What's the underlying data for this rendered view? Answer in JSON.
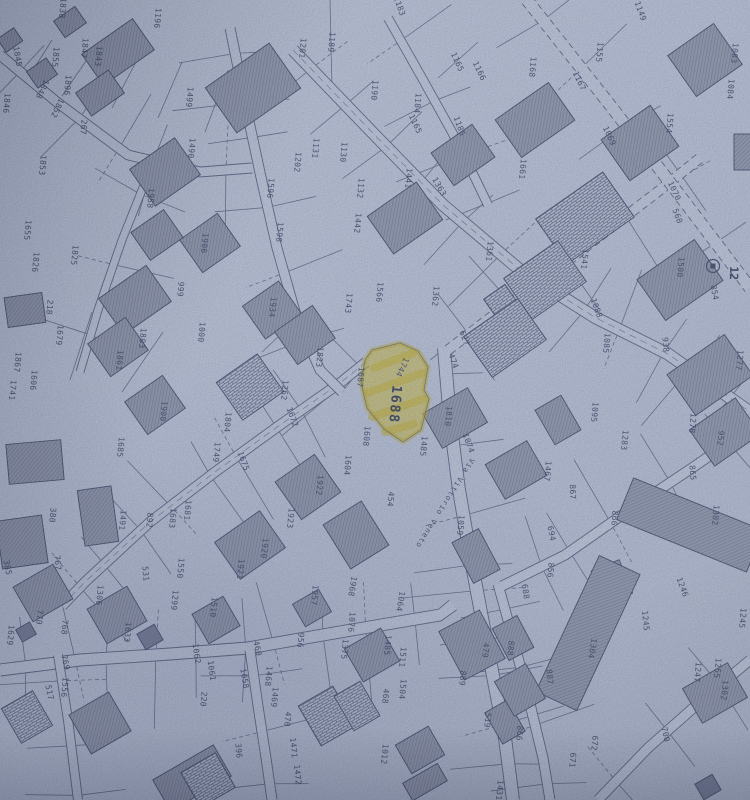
{
  "map": {
    "paper_color": "#c5cee1",
    "line_color": "#3e4968",
    "building_color": "#99a1b4",
    "highlight": {
      "parcel_number": "1688",
      "color": "#ddc62e"
    },
    "street": {
      "name": "Via Vittorio Veneto"
    },
    "marker": {
      "label": "12"
    },
    "labels": [
      [
        "1838",
        60,
        8,
        95
      ],
      [
        "1196",
        155,
        18,
        95
      ],
      [
        "1183",
        397,
        7,
        70
      ],
      [
        "1189",
        329,
        42,
        95
      ],
      [
        "1201",
        300,
        48,
        95
      ],
      [
        "1190",
        372,
        90,
        95
      ],
      [
        "1184",
        415,
        103,
        95
      ],
      [
        "1165",
        455,
        63,
        65
      ],
      [
        "1165",
        413,
        125,
        65
      ],
      [
        "1166",
        477,
        72,
        65
      ],
      [
        "1186",
        457,
        127,
        70
      ],
      [
        "1149",
        638,
        12,
        70
      ],
      [
        "1155",
        597,
        52,
        95
      ],
      [
        "1168",
        530,
        67,
        95
      ],
      [
        "1167",
        577,
        82,
        65
      ],
      [
        "1083",
        732,
        53,
        95
      ],
      [
        "1084",
        728,
        89,
        95
      ],
      [
        "1554",
        667,
        123,
        95
      ],
      [
        "1069",
        607,
        137,
        65
      ],
      [
        "1070",
        672,
        192,
        65
      ],
      [
        "1661",
        520,
        169,
        95
      ],
      [
        "1363",
        437,
        188,
        60
      ],
      [
        "1441",
        406,
        178,
        95
      ],
      [
        "1442",
        355,
        223,
        95
      ],
      [
        "1132",
        358,
        188,
        95
      ],
      [
        "1131",
        313,
        148,
        95
      ],
      [
        "1130",
        341,
        152,
        95
      ],
      [
        "1202",
        295,
        162,
        95
      ],
      [
        "1596",
        268,
        188,
        95
      ],
      [
        "1598",
        277,
        232,
        95
      ],
      [
        "1845",
        15,
        57,
        80
      ],
      [
        "1855",
        53,
        57,
        95
      ],
      [
        "1847",
        82,
        48,
        95
      ],
      [
        "1843",
        96,
        56,
        95
      ],
      [
        "1896",
        65,
        85,
        95
      ],
      [
        "1848",
        40,
        88,
        115
      ],
      [
        "1846",
        4,
        103,
        95
      ],
      [
        "1852",
        55,
        107,
        115
      ],
      [
        "267",
        81,
        127,
        95
      ],
      [
        "1853",
        40,
        165,
        95
      ],
      [
        "1499",
        187,
        97,
        95
      ],
      [
        "1490",
        189,
        148,
        95
      ],
      [
        "1958",
        148,
        198,
        95
      ],
      [
        "1906",
        202,
        243,
        95
      ],
      [
        "1655",
        25,
        230,
        95
      ],
      [
        "1826",
        33,
        262,
        95
      ],
      [
        "1825",
        72,
        255,
        95
      ],
      [
        "218",
        47,
        307,
        95
      ],
      [
        "1679",
        57,
        335,
        95
      ],
      [
        "999",
        178,
        289,
        95
      ],
      [
        "1000",
        199,
        332,
        95
      ],
      [
        "1803",
        140,
        338,
        95
      ],
      [
        "1934",
        270,
        307,
        95
      ],
      [
        "1823",
        317,
        357,
        95
      ],
      [
        "1566",
        377,
        292,
        95
      ],
      [
        "1743",
        346,
        303,
        95
      ],
      [
        "1362",
        433,
        296,
        95
      ],
      [
        "1361",
        487,
        251,
        95
      ],
      [
        "1541",
        582,
        259,
        95
      ],
      [
        "1500",
        678,
        267,
        95
      ],
      [
        "854",
        712,
        293,
        80
      ],
      [
        "560",
        675,
        217,
        70
      ],
      [
        "1088",
        594,
        309,
        70
      ],
      [
        "938",
        663,
        345,
        85
      ],
      [
        "1085",
        604,
        343,
        95
      ],
      [
        "1277",
        737,
        360,
        95
      ],
      [
        "1867",
        15,
        362,
        95
      ],
      [
        "1861",
        117,
        360,
        95
      ],
      [
        "1741",
        10,
        390,
        95
      ],
      [
        "1606",
        31,
        380,
        95
      ],
      [
        "1900",
        161,
        411,
        95
      ],
      [
        "1685",
        118,
        447,
        95
      ],
      [
        "1262",
        282,
        390,
        95
      ],
      [
        "1687",
        358,
        377,
        95
      ],
      [
        "1744",
        400,
        366,
        115
      ],
      [
        "1672",
        290,
        418,
        70
      ],
      [
        "1675",
        241,
        462,
        70
      ],
      [
        "1804",
        225,
        422,
        95
      ],
      [
        "1749",
        214,
        452,
        95
      ],
      [
        "1604",
        345,
        465,
        95
      ],
      [
        "1608",
        364,
        436,
        95
      ],
      [
        "1810",
        446,
        416,
        95
      ],
      [
        "1485",
        421,
        446,
        95
      ],
      [
        "1074",
        466,
        444,
        70
      ],
      [
        "627",
        462,
        339,
        70
      ],
      [
        "474",
        451,
        362,
        70
      ],
      [
        "1095",
        592,
        412,
        95
      ],
      [
        "1278",
        690,
        423,
        95
      ],
      [
        "952",
        718,
        438,
        95
      ],
      [
        "1283",
        622,
        440,
        95
      ],
      [
        "454",
        388,
        499,
        95
      ],
      [
        "1467",
        545,
        471,
        95
      ],
      [
        "867",
        570,
        492,
        88
      ],
      [
        "865",
        690,
        473,
        85
      ],
      [
        "866",
        612,
        518,
        95
      ],
      [
        "1302",
        713,
        515,
        95
      ],
      [
        "1922",
        317,
        485,
        95
      ],
      [
        "1923",
        288,
        518,
        95
      ],
      [
        "380",
        50,
        515,
        95
      ],
      [
        "1491",
        120,
        520,
        95
      ],
      [
        "892",
        147,
        520,
        95
      ],
      [
        "1681",
        185,
        510,
        95
      ],
      [
        "1683",
        170,
        518,
        95
      ],
      [
        "1059",
        458,
        525,
        95
      ],
      [
        "694",
        549,
        534,
        78
      ],
      [
        "1245",
        740,
        618,
        95
      ],
      [
        "1920",
        262,
        548,
        95
      ],
      [
        "1921",
        238,
        569,
        95
      ],
      [
        "1957",
        312,
        595,
        95
      ],
      [
        "1968",
        350,
        586,
        100
      ],
      [
        "1064",
        398,
        601,
        100
      ],
      [
        "856",
        548,
        570,
        95
      ],
      [
        "688",
        523,
        592,
        82
      ],
      [
        "1304",
        590,
        648,
        100
      ],
      [
        "1246",
        680,
        588,
        70
      ],
      [
        "1245",
        643,
        621,
        85
      ],
      [
        "672",
        592,
        743,
        95
      ],
      [
        "671",
        570,
        760,
        95
      ],
      [
        "700",
        663,
        735,
        78
      ],
      [
        "1247",
        695,
        672,
        95
      ],
      [
        "1255",
        715,
        668,
        95
      ],
      [
        "1302",
        722,
        690,
        95
      ],
      [
        "1076",
        349,
        622,
        95
      ],
      [
        "956",
        298,
        640,
        95
      ],
      [
        "1375",
        342,
        649,
        95
      ],
      [
        "1485",
        385,
        645,
        95
      ],
      [
        "1511",
        400,
        657,
        95
      ],
      [
        "1504",
        400,
        689,
        95
      ],
      [
        "468",
        383,
        696,
        95
      ],
      [
        "1012",
        382,
        754,
        95
      ],
      [
        "479",
        483,
        650,
        95
      ],
      [
        "888",
        508,
        648,
        95
      ],
      [
        "889",
        460,
        678,
        95
      ],
      [
        "887",
        547,
        677,
        85
      ],
      [
        "519",
        485,
        720,
        95
      ],
      [
        "866",
        517,
        733,
        95
      ],
      [
        "1431",
        497,
        790,
        95
      ],
      [
        "385",
        5,
        568,
        80
      ],
      [
        "767",
        55,
        563,
        85
      ],
      [
        "1306",
        97,
        595,
        95
      ],
      [
        "770",
        37,
        617,
        95
      ],
      [
        "768",
        62,
        627,
        95
      ],
      [
        "1629",
        8,
        635,
        95
      ],
      [
        "769",
        63,
        663,
        78
      ],
      [
        "517",
        47,
        693,
        78
      ],
      [
        "1556",
        62,
        687,
        95
      ],
      [
        "531",
        143,
        574,
        85
      ],
      [
        "1550",
        178,
        568,
        95
      ],
      [
        "1299",
        172,
        600,
        95
      ],
      [
        "1633",
        125,
        632,
        95
      ],
      [
        "1510",
        211,
        607,
        95
      ],
      [
        "1062",
        194,
        654,
        82
      ],
      [
        "1061",
        209,
        671,
        82
      ],
      [
        "460",
        255,
        649,
        78
      ],
      [
        "1058",
        242,
        679,
        80
      ],
      [
        "220",
        201,
        699,
        95
      ],
      [
        "396",
        236,
        751,
        85
      ],
      [
        "1468",
        266,
        676,
        95
      ],
      [
        "1469",
        272,
        697,
        95
      ],
      [
        "470",
        285,
        719,
        95
      ],
      [
        "1471",
        291,
        748,
        85
      ],
      [
        "1472",
        295,
        775,
        85
      ]
    ]
  }
}
